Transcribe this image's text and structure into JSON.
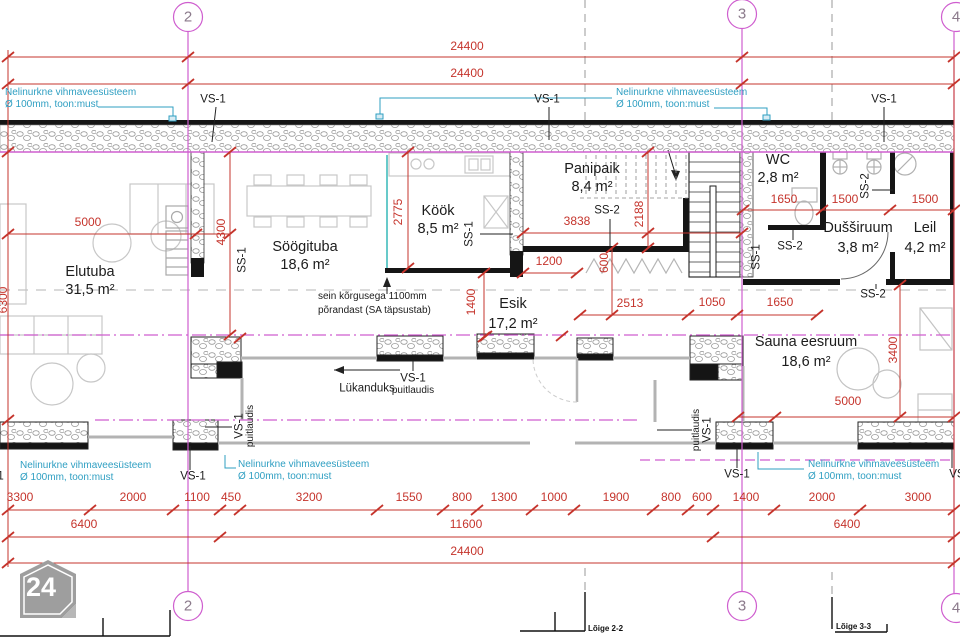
{
  "logo": {
    "text": "24"
  },
  "colors": {
    "dimension_red": "#c5342c",
    "grid_magenta": "#cf5ecf",
    "annotation_cyan": "#2f9fc2",
    "wall_black": "#151515",
    "furniture_gray": "#c7c7c7"
  },
  "labels": [
    {
      "name": "dim-top-24400-a",
      "text": "24400",
      "x": 467,
      "y": 46,
      "cls": "dim"
    },
    {
      "name": "dim-top-24400-b",
      "text": "24400",
      "x": 467,
      "y": 73,
      "cls": "dim"
    },
    {
      "name": "note-rainpipe-topleft-1",
      "text": "Nelinurkne vihmaveesüsteem",
      "x": 5,
      "y": 93,
      "cls": "note left"
    },
    {
      "name": "note-rainpipe-topleft-2",
      "text": "Ø 100mm, toon:must",
      "x": 5,
      "y": 105,
      "cls": "note left"
    },
    {
      "name": "vs1-top-left",
      "text": "VS-1",
      "x": 213,
      "y": 100,
      "cls": "ann"
    },
    {
      "name": "vs1-top-center",
      "text": "VS-1",
      "x": 547,
      "y": 100,
      "cls": "ann"
    },
    {
      "name": "note-rainpipe-topcenter-1",
      "text": "Nelinurkne vihmaveesüsteem",
      "x": 616,
      "y": 93,
      "cls": "note left"
    },
    {
      "name": "note-rainpipe-topcenter-2",
      "text": "Ø 100mm, toon:must",
      "x": 616,
      "y": 105,
      "cls": "note left"
    },
    {
      "name": "vs1-top-right",
      "text": "VS-1",
      "x": 884,
      "y": 100,
      "cls": "ann"
    },
    {
      "name": "grid-2-top",
      "text": "2",
      "x": 188,
      "y": 17,
      "cls": "grid"
    },
    {
      "name": "grid-3-top",
      "text": "3",
      "x": 742,
      "y": 14,
      "cls": "grid"
    },
    {
      "name": "grid-4-top",
      "text": "4",
      "x": 956,
      "y": 17,
      "cls": "grid"
    },
    {
      "name": "grid-2-bottom",
      "text": "2",
      "x": 188,
      "y": 606,
      "cls": "grid"
    },
    {
      "name": "grid-3-bottom",
      "text": "3",
      "x": 742,
      "y": 606,
      "cls": "grid"
    },
    {
      "name": "grid-4-bottom",
      "text": "4",
      "x": 956,
      "y": 608,
      "cls": "grid"
    },
    {
      "name": "room-elutuba",
      "text": "Elutuba",
      "x": 90,
      "y": 272,
      "cls": "room"
    },
    {
      "name": "room-elutuba-area",
      "text": "31,5 m²",
      "x": 90,
      "y": 290,
      "cls": "room"
    },
    {
      "name": "room-soogituba",
      "text": "Söögituba",
      "x": 305,
      "y": 247,
      "cls": "room"
    },
    {
      "name": "room-soogituba-area",
      "text": "18,6 m²",
      "x": 305,
      "y": 265,
      "cls": "room"
    },
    {
      "name": "room-kook",
      "text": "Köök",
      "x": 438,
      "y": 211,
      "cls": "room"
    },
    {
      "name": "room-kook-area",
      "text": "8,5 m²",
      "x": 438,
      "y": 229,
      "cls": "room"
    },
    {
      "name": "room-panipaik",
      "text": "Panipaik",
      "x": 592,
      "y": 169,
      "cls": "room"
    },
    {
      "name": "room-panipaik-area",
      "text": "8,4 m²",
      "x": 592,
      "y": 187,
      "cls": "room"
    },
    {
      "name": "room-esik",
      "text": "Esik",
      "x": 513,
      "y": 304,
      "cls": "room"
    },
    {
      "name": "room-esik-area",
      "text": "17,2 m²",
      "x": 513,
      "y": 324,
      "cls": "room"
    },
    {
      "name": "room-wc",
      "text": "WC",
      "x": 778,
      "y": 160,
      "cls": "room"
    },
    {
      "name": "room-wc-area",
      "text": "2,8 m²",
      "x": 778,
      "y": 178,
      "cls": "room"
    },
    {
      "name": "room-dussiruum",
      "text": "Dušširuum",
      "x": 858,
      "y": 228,
      "cls": "room"
    },
    {
      "name": "room-dussiruum-area",
      "text": "3,8 m²",
      "x": 858,
      "y": 248,
      "cls": "room"
    },
    {
      "name": "room-leil",
      "text": "Leil",
      "x": 925,
      "y": 228,
      "cls": "room"
    },
    {
      "name": "room-leil-area",
      "text": "4,2 m²",
      "x": 925,
      "y": 248,
      "cls": "room"
    },
    {
      "name": "room-sauna-eesruum",
      "text": "Sauna eesruum",
      "x": 806,
      "y": 342,
      "cls": "room"
    },
    {
      "name": "room-sauna-eesruum-area",
      "text": "18,6 m²",
      "x": 806,
      "y": 362,
      "cls": "room"
    },
    {
      "name": "dim-elutuba-5000",
      "text": "5000",
      "x": 88,
      "y": 222,
      "cls": "dim"
    },
    {
      "name": "dim-4300",
      "text": "4300",
      "x": 221,
      "y": 232,
      "cls": "dim rot"
    },
    {
      "name": "dim-2775",
      "text": "2775",
      "x": 398,
      "y": 212,
      "cls": "dim rot"
    },
    {
      "name": "dim-3838",
      "text": "3838",
      "x": 577,
      "y": 221,
      "cls": "dim"
    },
    {
      "name": "dim-2188",
      "text": "2188",
      "x": 639,
      "y": 214,
      "cls": "dim rot"
    },
    {
      "name": "dim-1200",
      "text": "1200",
      "x": 549,
      "y": 261,
      "cls": "dim"
    },
    {
      "name": "dim-600",
      "text": "600",
      "x": 604,
      "y": 263,
      "cls": "dim rot"
    },
    {
      "name": "dim-1400",
      "text": "1400",
      "x": 471,
      "y": 302,
      "cls": "dim rot"
    },
    {
      "name": "dim-2513",
      "text": "2513",
      "x": 630,
      "y": 303,
      "cls": "dim"
    },
    {
      "name": "dim-1050",
      "text": "1050",
      "x": 712,
      "y": 302,
      "cls": "dim"
    },
    {
      "name": "dim-1650-hall",
      "text": "1650",
      "x": 780,
      "y": 302,
      "cls": "dim"
    },
    {
      "name": "dim-1650-wc",
      "text": "1650",
      "x": 784,
      "y": 199,
      "cls": "dim"
    },
    {
      "name": "dim-1500-duss",
      "text": "1500",
      "x": 845,
      "y": 199,
      "cls": "dim"
    },
    {
      "name": "dim-1500-leil",
      "text": "1500",
      "x": 925,
      "y": 199,
      "cls": "dim"
    },
    {
      "name": "dim-3400",
      "text": "3400",
      "x": 893,
      "y": 350,
      "cls": "dim rot"
    },
    {
      "name": "dim-5000-sauna",
      "text": "5000",
      "x": 848,
      "y": 401,
      "cls": "dim"
    },
    {
      "name": "dim-6300",
      "text": "6300",
      "x": 3,
      "y": 300,
      "cls": "dim rot"
    },
    {
      "name": "ss1-soogituba",
      "text": "SS-1",
      "x": 243,
      "y": 260,
      "cls": "ann rot"
    },
    {
      "name": "ss1-kook",
      "text": "SS-1",
      "x": 470,
      "y": 234,
      "cls": "ann rot"
    },
    {
      "name": "ss2-panipaik",
      "text": "SS-2",
      "x": 607,
      "y": 211,
      "cls": "ann"
    },
    {
      "name": "ss1-stair",
      "text": "SS-1",
      "x": 757,
      "y": 257,
      "cls": "ann rot"
    },
    {
      "name": "ss2-wc",
      "text": "SS-2",
      "x": 790,
      "y": 247,
      "cls": "ann"
    },
    {
      "name": "ss2-duss",
      "text": "SS-2",
      "x": 866,
      "y": 186,
      "cls": "ann rot"
    },
    {
      "name": "ss2-sauna",
      "text": "SS-2",
      "x": 873,
      "y": 295,
      "cls": "ann"
    },
    {
      "name": "note-sein-1",
      "text": "sein kõrgusega  1100mm",
      "x": 318,
      "y": 297,
      "cls": "small left"
    },
    {
      "name": "note-sein-2",
      "text": "põrandast (SA täpsustab)",
      "x": 318,
      "y": 311,
      "cls": "small left"
    },
    {
      "name": "lukanduks",
      "text": "Lükanduks",
      "x": 367,
      "y": 389,
      "cls": "ann"
    },
    {
      "name": "vs1-slidewall",
      "text": "VS-1",
      "x": 413,
      "y": 379,
      "cls": "ann"
    },
    {
      "name": "puitlaudis-slidewall",
      "text": "puitlaudis",
      "x": 413,
      "y": 391,
      "cls": "small"
    },
    {
      "name": "vs1-pier-left",
      "text": "VS-1",
      "x": 240,
      "y": 426,
      "cls": "ann rot"
    },
    {
      "name": "puitlaudis-pier-left",
      "text": "puitlaudis",
      "x": 251,
      "y": 426,
      "cls": "small rot"
    },
    {
      "name": "puitlaudis-pier-right",
      "text": "puitlaudis",
      "x": 697,
      "y": 430,
      "cls": "small rot"
    },
    {
      "name": "vs1-pier-right",
      "text": "VS-1",
      "x": 708,
      "y": 430,
      "cls": "ann rot"
    },
    {
      "name": "vs1-bottom-left",
      "text": "VS-1",
      "x": 193,
      "y": 477,
      "cls": "ann"
    },
    {
      "name": "vs1-bottom-center",
      "text": "VS-1",
      "x": 737,
      "y": 475,
      "cls": "ann"
    },
    {
      "name": "vs1-bottom-edge-left",
      "text": "VS-1",
      "x": -9,
      "y": 477,
      "cls": "ann"
    },
    {
      "name": "vs1-bottom-right",
      "text": "VS-1",
      "x": 962,
      "y": 475,
      "cls": "ann"
    },
    {
      "name": "note-rainpipe-botedge-1",
      "text": "Nelinurkne vihmaveesüsteem",
      "x": 20,
      "y": 466,
      "cls": "note left"
    },
    {
      "name": "note-rainpipe-botedge-2",
      "text": "Ø 100mm, toon:must",
      "x": 20,
      "y": 478,
      "cls": "note left"
    },
    {
      "name": "note-rainpipe-botleft-1",
      "text": "Nelinurkne vihmaveesüsteem",
      "x": 238,
      "y": 465,
      "cls": "note left"
    },
    {
      "name": "note-rainpipe-botleft-2",
      "text": "Ø 100mm, toon:must",
      "x": 238,
      "y": 477,
      "cls": "note left"
    },
    {
      "name": "note-rainpipe-botright-1",
      "text": "Nelinurkne vihmaveesüsteem",
      "x": 808,
      "y": 465,
      "cls": "note left"
    },
    {
      "name": "note-rainpipe-botright-2",
      "text": "Ø 100mm, toon:must",
      "x": 808,
      "y": 477,
      "cls": "note left"
    },
    {
      "name": "chain1-3300",
      "text": "3300",
      "x": 20,
      "y": 497,
      "cls": "dim"
    },
    {
      "name": "chain1-2000a",
      "text": "2000",
      "x": 133,
      "y": 497,
      "cls": "dim"
    },
    {
      "name": "chain1-1100",
      "text": "1100",
      "x": 197,
      "y": 497,
      "cls": "dim"
    },
    {
      "name": "chain1-450",
      "text": "450",
      "x": 231,
      "y": 497,
      "cls": "dim"
    },
    {
      "name": "chain1-3200",
      "text": "3200",
      "x": 309,
      "y": 497,
      "cls": "dim"
    },
    {
      "name": "chain1-1550",
      "text": "1550",
      "x": 409,
      "y": 497,
      "cls": "dim"
    },
    {
      "name": "chain1-800a",
      "text": "800",
      "x": 462,
      "y": 497,
      "cls": "dim"
    },
    {
      "name": "chain1-1300",
      "text": "1300",
      "x": 504,
      "y": 497,
      "cls": "dim"
    },
    {
      "name": "chain1-1000",
      "text": "1000",
      "x": 554,
      "y": 497,
      "cls": "dim"
    },
    {
      "name": "chain1-1900",
      "text": "1900",
      "x": 616,
      "y": 497,
      "cls": "dim"
    },
    {
      "name": "chain1-800b",
      "text": "800",
      "x": 671,
      "y": 497,
      "cls": "dim"
    },
    {
      "name": "chain1-600",
      "text": "600",
      "x": 702,
      "y": 497,
      "cls": "dim"
    },
    {
      "name": "chain1-1400",
      "text": "1400",
      "x": 746,
      "y": 497,
      "cls": "dim"
    },
    {
      "name": "chain1-2000b",
      "text": "2000",
      "x": 822,
      "y": 497,
      "cls": "dim"
    },
    {
      "name": "chain1-3000",
      "text": "3000",
      "x": 918,
      "y": 497,
      "cls": "dim"
    },
    {
      "name": "chain2-6400a",
      "text": "6400",
      "x": 84,
      "y": 524,
      "cls": "dim"
    },
    {
      "name": "chain2-11600",
      "text": "11600",
      "x": 466,
      "y": 524,
      "cls": "dim"
    },
    {
      "name": "chain2-6400b",
      "text": "6400",
      "x": 847,
      "y": 524,
      "cls": "dim"
    },
    {
      "name": "chain3-24400",
      "text": "24400",
      "x": 467,
      "y": 551,
      "cls": "dim"
    },
    {
      "name": "section-loige-2-2",
      "text": "Lõige 2-2",
      "x": 588,
      "y": 629,
      "cls": "tiny left"
    },
    {
      "name": "section-loige-3-3",
      "text": "Lõige 3-3",
      "x": 836,
      "y": 627,
      "cls": "tiny left"
    }
  ]
}
